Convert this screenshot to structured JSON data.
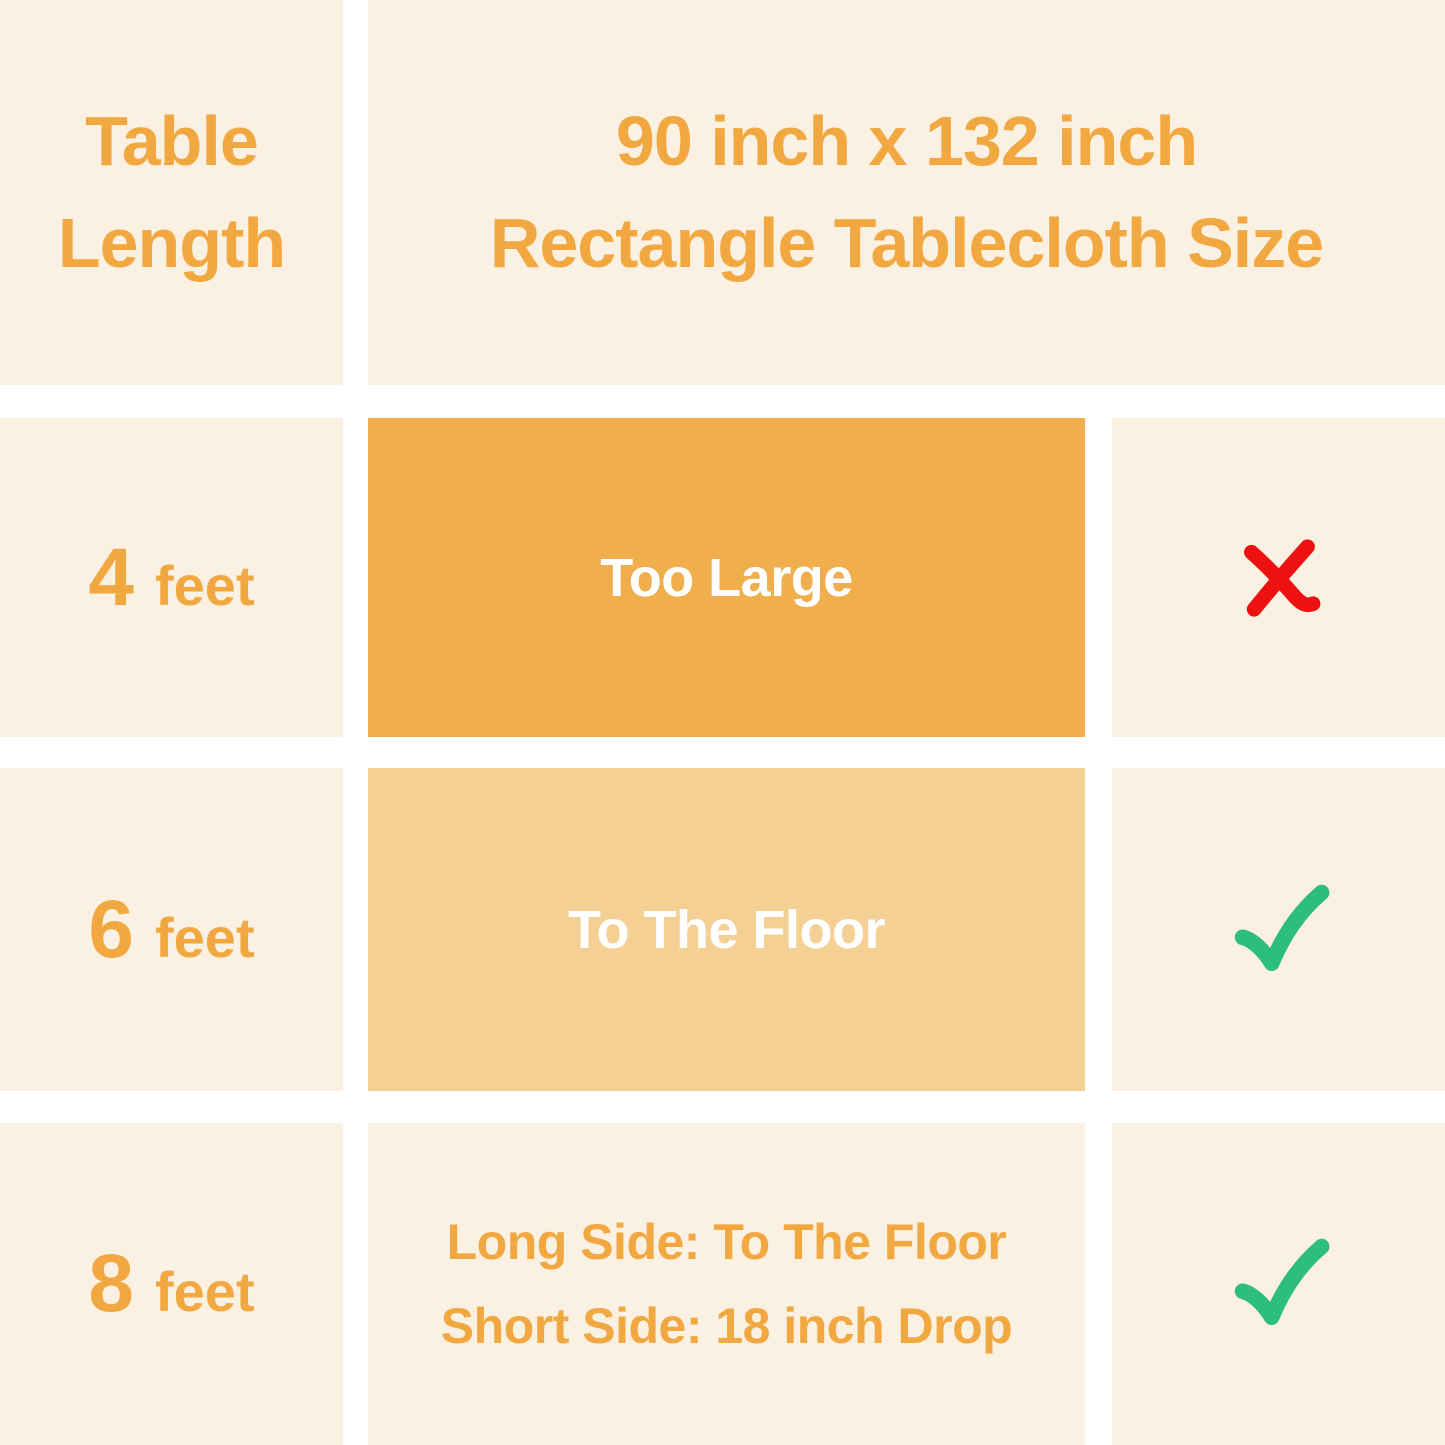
{
  "title": "90 inch x 132 inch Rectangle Tablecloth Size fit chart",
  "colors": {
    "gutter_white": "#FFFFFF",
    "cell_cream": "#FBF1E2",
    "fit_box_dark_orange": "#F1AE4D",
    "fit_box_light_orange": "#F5D094",
    "text_orange": "#F1A841",
    "box_text_white": "#FFFFFF",
    "cross_red": "#ED1111",
    "check_green": "#2EBE7C"
  },
  "header": {
    "length_column_title": "Table\nLength",
    "size_column_title": "90 inch x 132 inch\nRectangle Tablecloth Size"
  },
  "rows": [
    {
      "length_value": "4",
      "length_unit": "feet",
      "fit": "Too Large",
      "fit_box": "dark-orange",
      "verdict": "not-suitable",
      "verdict_icon": "red-cross-icon"
    },
    {
      "length_value": "6",
      "length_unit": "feet",
      "fit": "To The Floor",
      "fit_box": "light-orange",
      "verdict": "suitable",
      "verdict_icon": "green-check-icon"
    },
    {
      "length_value": "8",
      "length_unit": "feet",
      "fit": "Long Side: To The Floor\nShort Side: 18 inch Drop",
      "fit_box": "none",
      "verdict": "suitable",
      "verdict_icon": "green-check-icon"
    }
  ],
  "chart_data": {
    "type": "table",
    "title": "90 inch x 132 inch Rectangle Tablecloth Size",
    "columns": [
      "Table Length",
      "90 inch x 132 inch Rectangle Tablecloth Size",
      "Suitable"
    ],
    "rows": [
      [
        "4 feet",
        "Too Large",
        "no"
      ],
      [
        "6 feet",
        "To The Floor",
        "yes"
      ],
      [
        "8 feet",
        "Long Side: To The Floor; Short Side: 18 inch Drop",
        "yes"
      ]
    ]
  }
}
